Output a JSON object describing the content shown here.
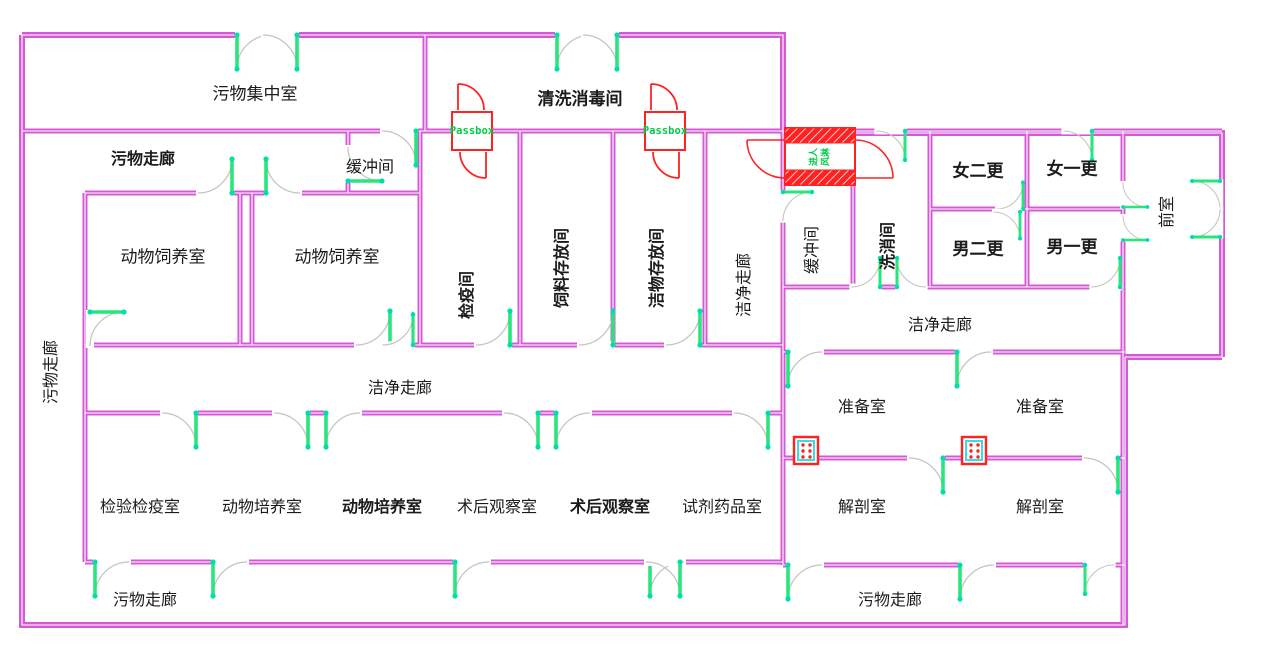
{
  "plan_type": "laboratory-animal-facility-floor-plan",
  "colors": {
    "wall": "#d558d5",
    "wall_core": "#ffffff",
    "door_leaf": "#29e57d",
    "door_hinge": "#00dfa8",
    "door_arc": "#c4c4c4",
    "special_red": "#ff2222",
    "passbox_text_green": "#00cc44",
    "label_black": "#1b1b1b",
    "transfer_window_cyan": "#35e0e0"
  },
  "labels": [
    {
      "text": "污物集中室"
    },
    {
      "text": "清洗消毒间"
    },
    {
      "text": "污物走廊"
    },
    {
      "text": "缓冲间"
    },
    {
      "text": "动物饲养室"
    },
    {
      "text": "动物饲养室"
    },
    {
      "text": "检疫间"
    },
    {
      "text": "饲料存放间"
    },
    {
      "text": "洁物存放间"
    },
    {
      "text": "洁净走廊"
    },
    {
      "text": "缓冲间"
    },
    {
      "text": "洗消间"
    },
    {
      "text": "女二更"
    },
    {
      "text": "女一更"
    },
    {
      "text": "男二更"
    },
    {
      "text": "男一更"
    },
    {
      "text": "前室"
    },
    {
      "text": "洁净走廊"
    },
    {
      "text": "污物走廊"
    },
    {
      "text": "洁净走廊"
    },
    {
      "text": "准备室"
    },
    {
      "text": "准备室"
    },
    {
      "text": "检验检疫室"
    },
    {
      "text": "动物培养室"
    },
    {
      "text": "动物培养室"
    },
    {
      "text": "术后观察室"
    },
    {
      "text": "术后观察室"
    },
    {
      "text": "试剂药品室"
    },
    {
      "text": "解剖室"
    },
    {
      "text": "解剖室"
    },
    {
      "text": "污物走廊"
    },
    {
      "text": "污物走廊"
    },
    {
      "text": "Passbox"
    },
    {
      "text": "Passbox"
    },
    {
      "text": "进人"
    },
    {
      "text": "风淋"
    }
  ]
}
